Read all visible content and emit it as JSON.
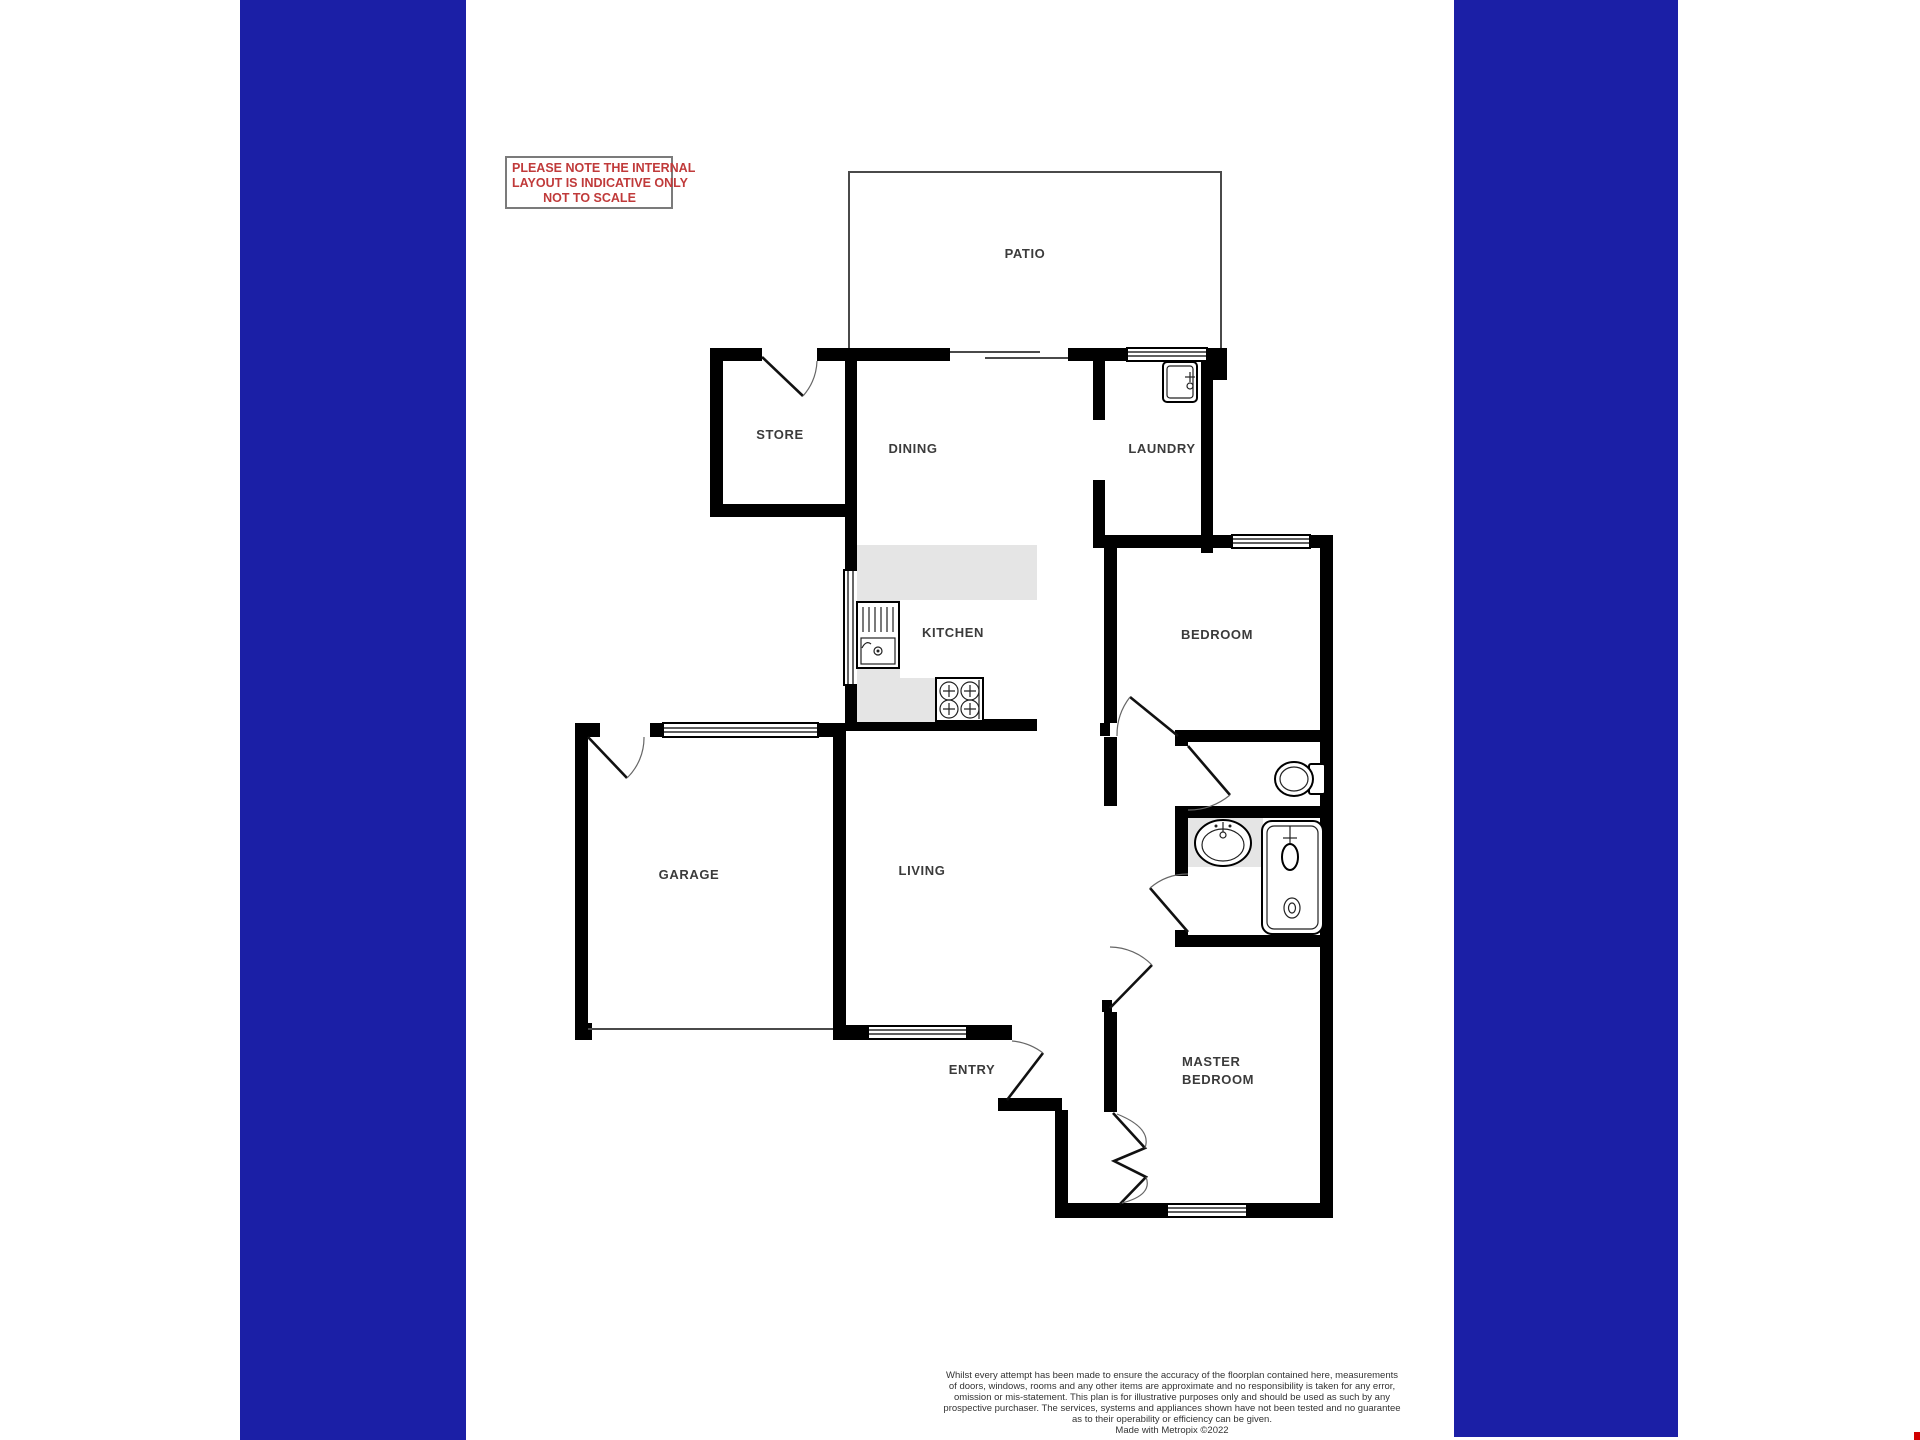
{
  "note": {
    "line1": "PLEASE NOTE THE INTERNAL",
    "line2": "LAYOUT IS INDICATIVE ONLY",
    "line3": "NOT TO SCALE"
  },
  "rooms": {
    "patio": "PATIO",
    "store": "STORE",
    "dining": "DINING",
    "laundry": "LAUNDRY",
    "kitchen": "KITCHEN",
    "bedroom": "BEDROOM",
    "garage": "GARAGE",
    "living": "LIVING",
    "entry": "ENTRY",
    "master_line1": "MASTER",
    "master_line2": "BEDROOM"
  },
  "disclaimer": {
    "line1": "Whilst every attempt has been made to ensure the accuracy of the floorplan contained here, measurements",
    "line2": "of doors, windows, rooms and any other items are approximate and no responsibility is taken for any error,",
    "line3": "omission or mis-statement. This plan is for illustrative purposes only and should be used as such by any",
    "line4": "prospective purchaser. The services, systems and appliances shown have not been tested and no guarantee",
    "line5": "as to their operability or efficiency can be given.",
    "credit": "Made with Metropix ©2022"
  },
  "colors": {
    "sidebar_blue": "#1B1FA6",
    "note_red": "#C03A3A",
    "wall_black": "#000000",
    "counter_gray": "#E5E5E5",
    "label_gray": "#3B3B3B",
    "corner_red": "#D10000"
  }
}
